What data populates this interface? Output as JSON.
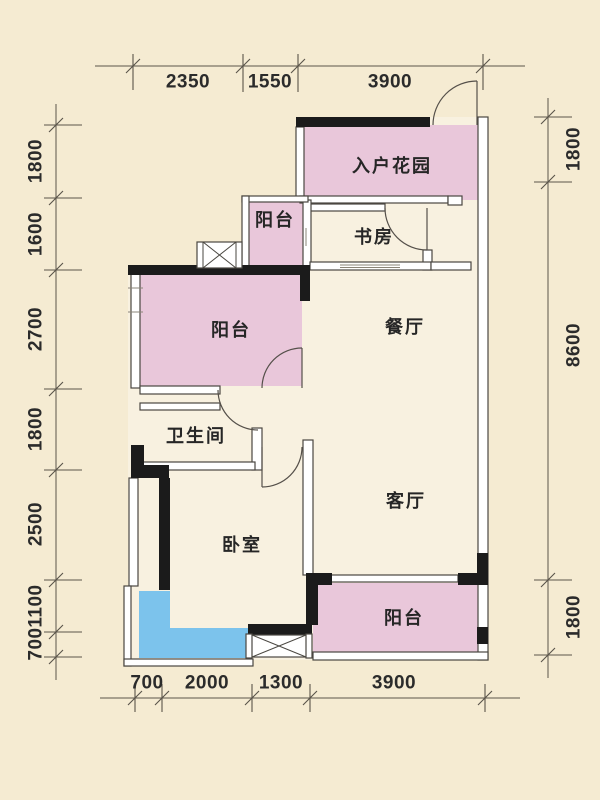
{
  "drawing": {
    "kind": "apartment floor plan",
    "language": "zh-CN"
  },
  "rooms": {
    "entry_garden": "入户花园",
    "balcony_top": "阳台",
    "study": "书房",
    "dining": "餐厅",
    "balcony_left": "阳台",
    "bathroom": "卫生间",
    "living": "客厅",
    "bedroom": "卧室",
    "balcony_bottom": "阳台"
  },
  "dims": {
    "top": [
      "2350",
      "1550",
      "3900"
    ],
    "left": [
      "1800",
      "1600",
      "2700",
      "1800",
      "2500",
      "1100",
      "700"
    ],
    "right": [
      "1800",
      "8600",
      "1800"
    ],
    "bottom": [
      "700",
      "2000",
      "1300",
      "3900"
    ]
  },
  "colors": {
    "background": "#f5ebd2",
    "interior": "#f8f1e0",
    "room_pink": "#e9c7da",
    "bay_blue": "#7cc3ec",
    "wall_black": "#1b1b1b",
    "line_gray": "#5a544a"
  }
}
